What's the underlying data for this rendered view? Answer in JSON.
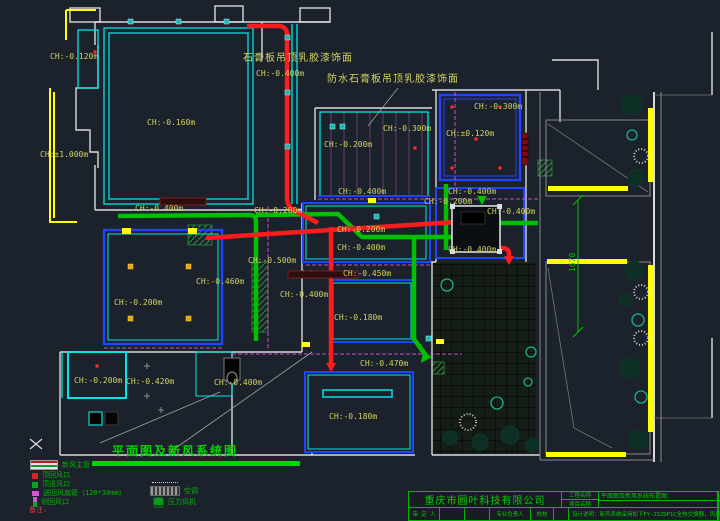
{
  "plan": {
    "title": "平面图及新风系统图",
    "ceiling_note_gypsum": "石膏板吊顶乳胶漆饰面",
    "ceiling_note_waterproof": "防水石膏板吊顶乳胶漆饰面",
    "dimension": "1670",
    "labels": [
      "CH:-0.120m",
      "CH:±1.000m",
      "CH:-0.160m",
      "CH:-0.400m",
      "CH:-0.200m",
      "CH:-0.300m",
      "CH:±0.120m",
      "CH:-0.300m",
      "CH:-0.400m",
      "CH:-0.400m",
      "CH:-0.200m",
      "CH:-0.200m",
      "CH:-0.400m",
      "CH:-0.400m",
      "CH:-0.400m",
      "CH:-0.400m",
      "CH:-0.200m",
      "CH:-0.500m",
      "CH:-0.460m",
      "CH:-0.400m",
      "CH:-0.450m",
      "CH:-0.200m",
      "CH:-0.200m",
      "CH:-0.420m",
      "CH:-0.400m",
      "CH:-0.180m",
      "CH:-0.470m",
      "CH:-0.180m"
    ]
  },
  "legend": {
    "items": [
      {
        "icon": "main-duct-symbol",
        "label": "新风主管"
      },
      {
        "icon": "return-vent-symbol",
        "label": "顶回风口"
      },
      {
        "icon": "supply-vent-symbol",
        "label": "顶送风口"
      },
      {
        "icon": "flat-duct-symbol",
        "label": "送回风扁管（120*30mm）"
      },
      {
        "icon": "side-vent-symbol",
        "label": "侧回风口"
      }
    ],
    "note_label": "备注:",
    "extra_items": [
      {
        "icon": "ac-unit-symbol",
        "label": "空调"
      },
      {
        "icon": "pressure-fan-symbol",
        "label": "压力风机"
      }
    ]
  },
  "title_block": {
    "company": "重庆市圆叶科技有限公司",
    "project_name_label": "工程名称",
    "item_name_label": "项目名称",
    "project_value": "平面图及新风系统布置图",
    "approver_label": "审 定 人",
    "discipline_lead_label": "专业负责人",
    "checker_label": "校核",
    "design_note": "设计说明：新风系统采用松下FY-25ZDP1C全热交换器，风量250。"
  },
  "colors": {
    "background": "#1b222b",
    "wall": "#d9d9d9",
    "cyan": "#00e5e5",
    "blue": "#2043ff",
    "red": "#fb1d1d",
    "green": "#00bf00",
    "yellow": "#ffff00",
    "magenta": "#d255d2",
    "label_yellow": "#d3d35f",
    "title_green": "#00d400"
  }
}
